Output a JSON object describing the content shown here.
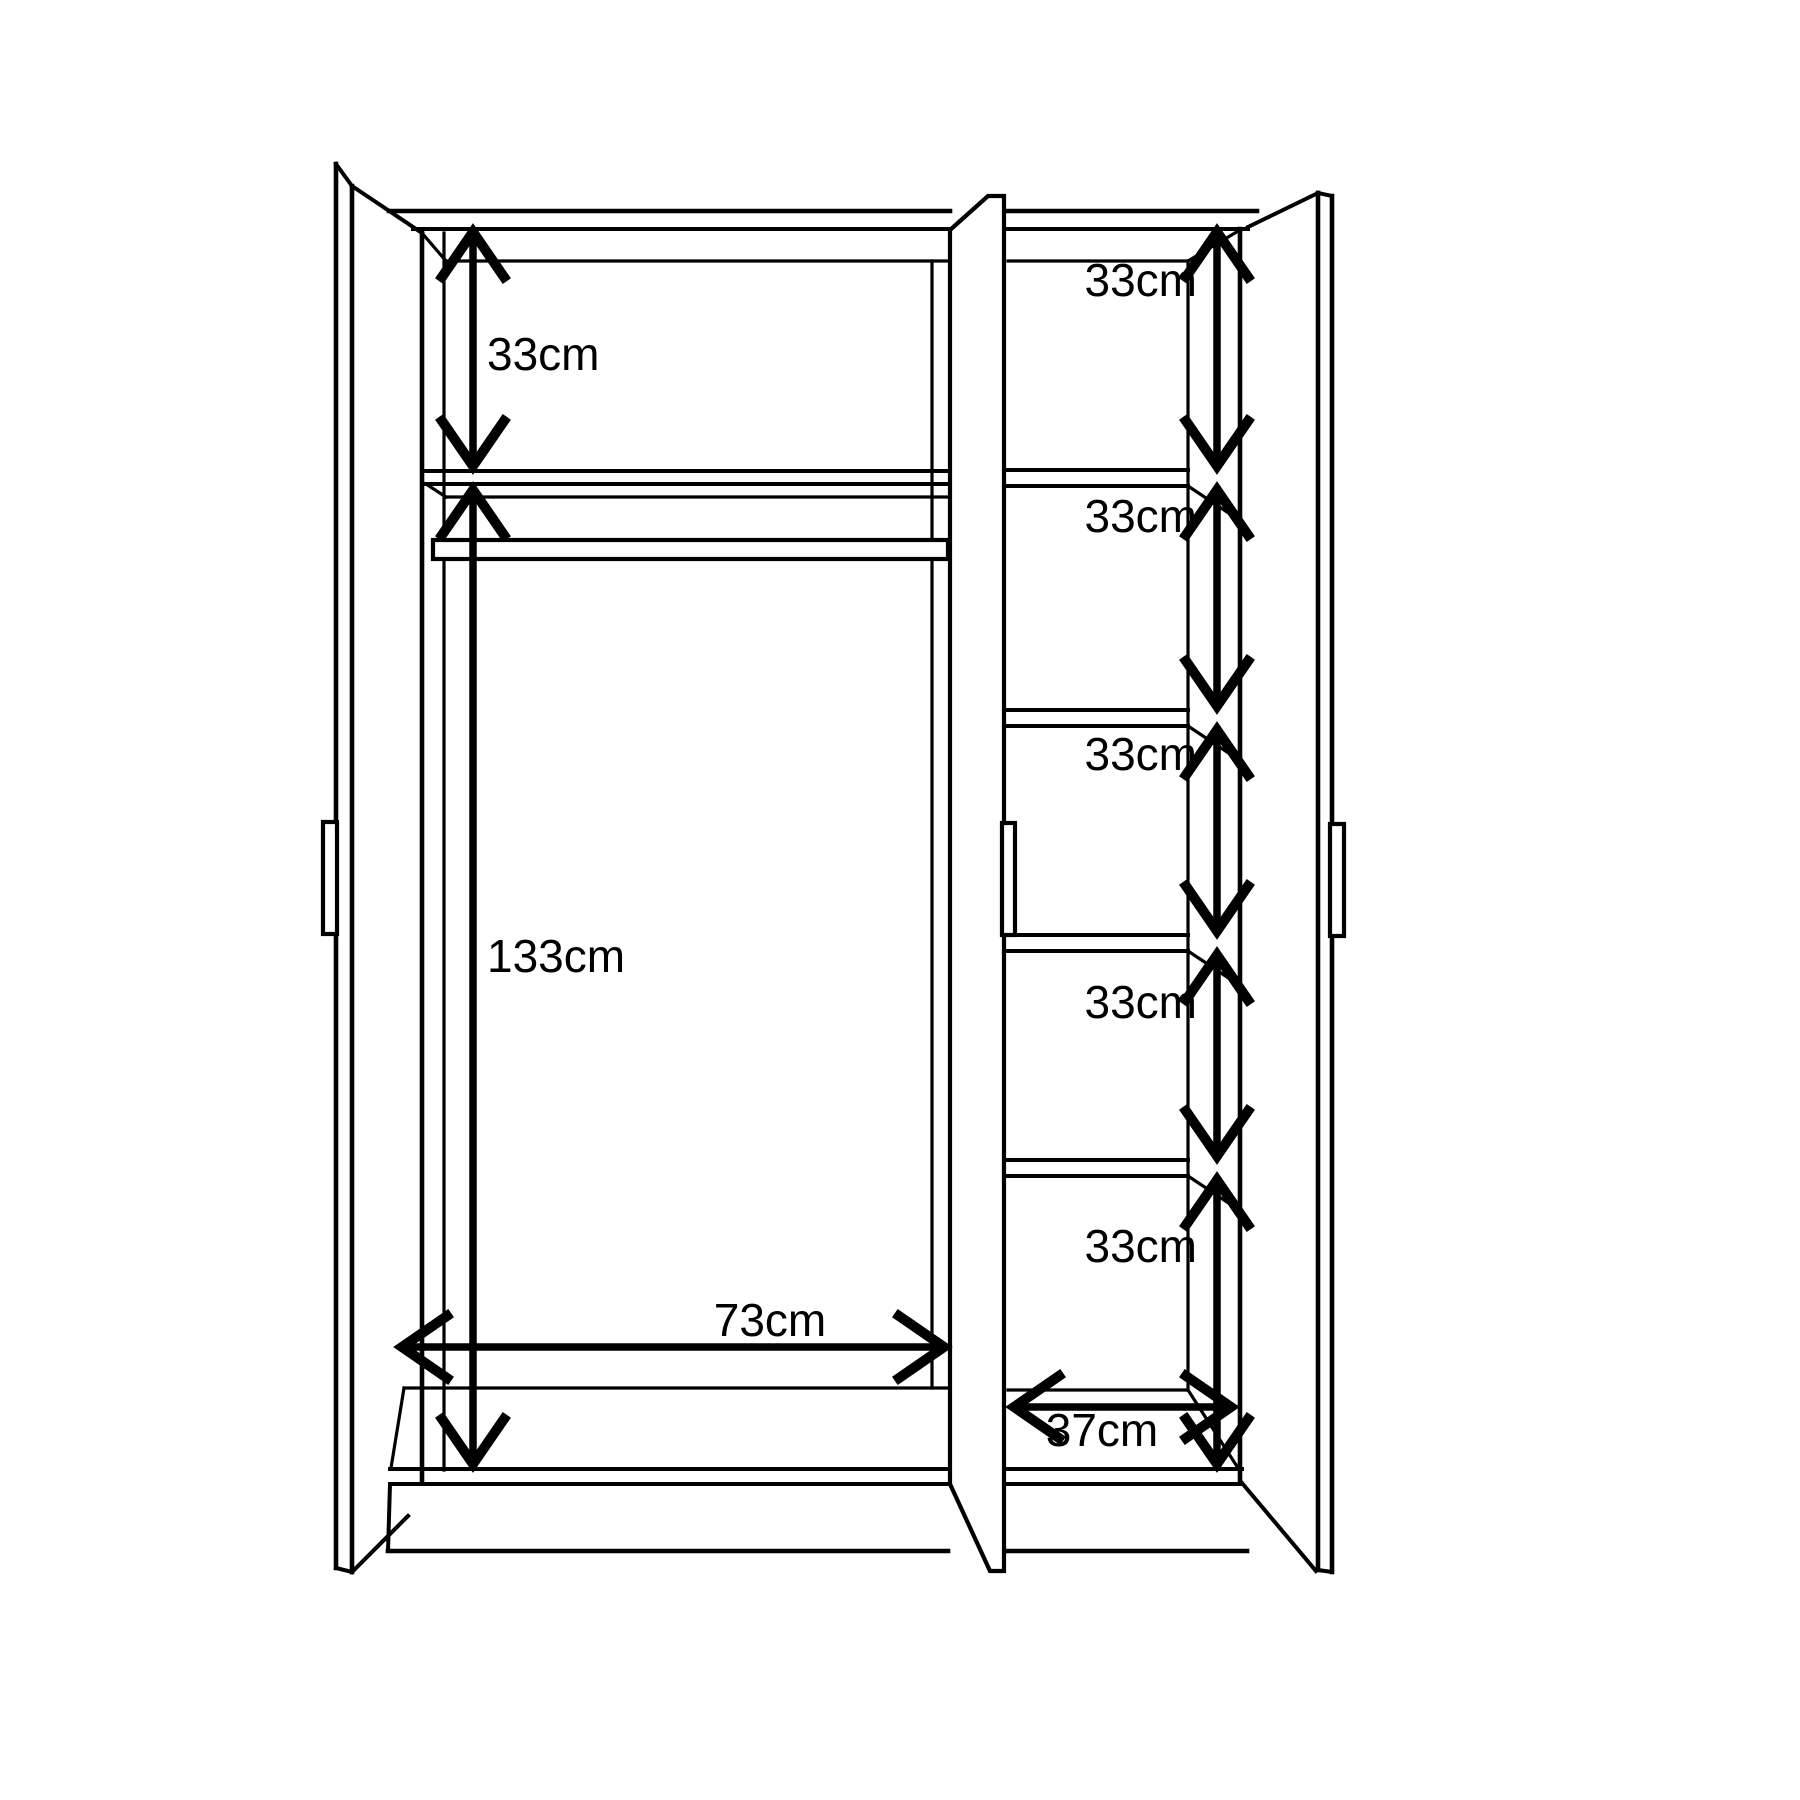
{
  "page": {
    "background_color": "#ffffff",
    "line_color": "#000000"
  },
  "dimensions": {
    "left_top_space": "33cm",
    "left_hanging_space": "133cm",
    "left_width": "73cm",
    "right_compartments": [
      "33cm",
      "33cm",
      "33cm",
      "33cm",
      "33cm"
    ],
    "right_width": "37cm"
  }
}
